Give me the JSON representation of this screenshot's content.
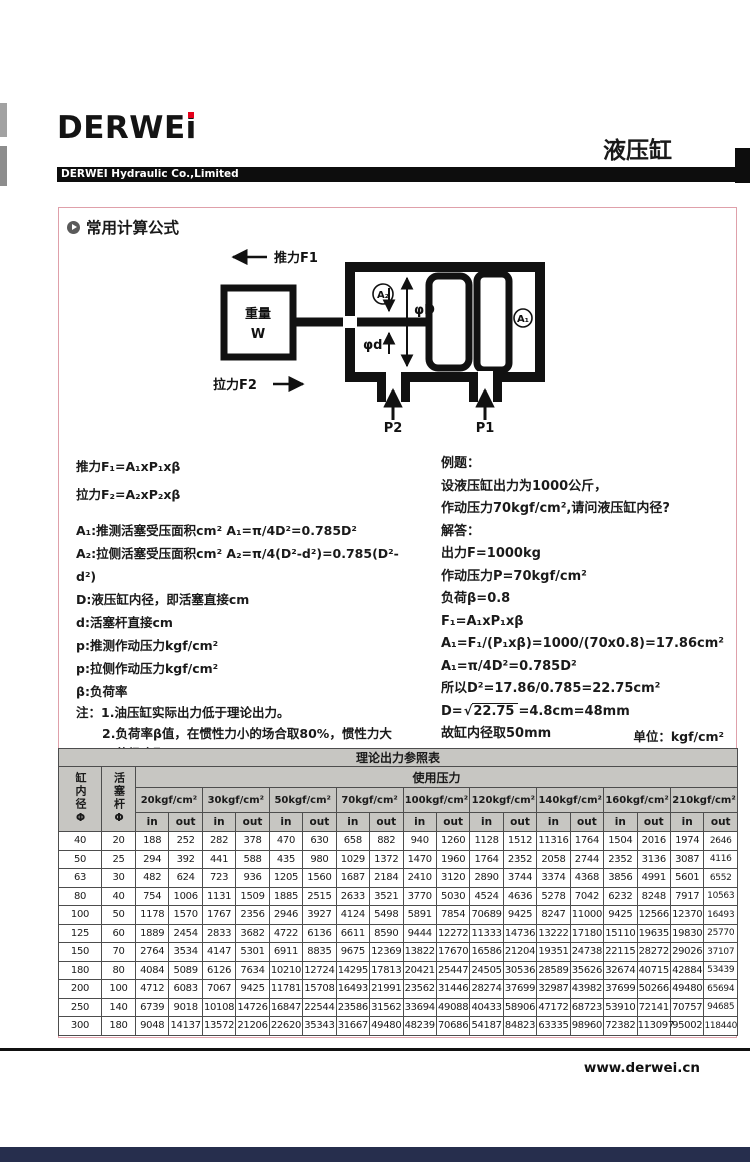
{
  "header": {
    "logo_text": "DERWE",
    "logo_i": "i",
    "page_title": "液压缸",
    "company": "DERWEI Hydraulic Co.,Limited"
  },
  "section": {
    "title": "常用计算公式"
  },
  "diagram": {
    "push_label": "推力F1",
    "pull_label": "拉力F2",
    "weight_line1": "重量",
    "weight_line2": "W",
    "a1_label": "A₁",
    "a2_label": "A₂",
    "dia_D": "φD",
    "dia_d": "φd",
    "p1_label": "P1",
    "p2_label": "P2"
  },
  "formulas": {
    "force_lines": [
      "推力F₁=A₁xP₁xβ",
      "拉力F₂=A₂xP₂xβ"
    ],
    "def_lines": [
      "A₁:推测活塞受压面积cm²  A₁=π/4D²=0.785D²",
      "A₂:拉侧活塞受压面积cm²  A₂=π/4(D²-d²)=0.785(D²-d²)",
      "D:液压缸内径，即活塞直接cm",
      "d:活塞杆直接cm",
      "p:推测作动压力kgf/cm²",
      "p:拉侧作动压力kgf/cm²",
      "β:负荷率"
    ],
    "note_lines": [
      "注：1.油压缸实际出力低于理论出力。",
      "2.负荷率β值，在惯性力小的场合取80%，惯性力大",
      "的场合取60%。"
    ]
  },
  "example": {
    "title": "例题：",
    "question_lines": [
      "设液压缸出力为1000公斤，",
      "作动压力70kgf/cm²,请问液压缸内径?"
    ],
    "answer_label": "解答：",
    "work_lines": [
      "出力F=1000kg",
      "作动压力P=70kgf/cm²",
      "负荷β=0.8",
      "F₁=A₁xP₁xβ",
      "A₁=F₁/(P₁xβ)=1000/(70x0.8)=17.86cm²",
      "A₁=π/4D²=0.785D²",
      "所以D²=17.86/0.785=22.75cm²"
    ],
    "sqrt": {
      "prefix": "D=",
      "sign": "√",
      "value": "22.75",
      "suffix": "=4.8cm=48mm"
    },
    "final_line": "故缸内径取50mm"
  },
  "unit_note": "单位：kgf/cm²",
  "table": {
    "title": "理论出力参照表",
    "col1_header": "缸内径Φ",
    "col2_header": "活塞杆Φ",
    "pressure_header": "使用压力",
    "pressures": [
      "20kgf/cm²",
      "30kgf/cm²",
      "50kgf/cm²",
      "70kgf/cm²",
      "100kgf/cm²",
      "120kgf/cm²",
      "140kgf/cm²",
      "160kgf/cm²",
      "210kgf/cm²"
    ],
    "in_label": "in",
    "out_label": "out",
    "rows": [
      [
        40,
        20,
        188,
        252,
        282,
        378,
        470,
        630,
        658,
        882,
        940,
        1260,
        1128,
        1512,
        11316,
        1764,
        1504,
        2016,
        1974,
        2646
      ],
      [
        50,
        25,
        294,
        392,
        441,
        588,
        435,
        980,
        1029,
        1372,
        1470,
        1960,
        1764,
        2352,
        2058,
        2744,
        2352,
        3136,
        3087,
        4116
      ],
      [
        63,
        30,
        482,
        624,
        723,
        936,
        1205,
        1560,
        1687,
        2184,
        2410,
        3120,
        2890,
        3744,
        3374,
        4368,
        3856,
        4991,
        5601,
        6552
      ],
      [
        80,
        40,
        754,
        1006,
        1131,
        1509,
        1885,
        2515,
        2633,
        3521,
        3770,
        5030,
        4524,
        4636,
        5278,
        7042,
        6232,
        8248,
        7917,
        10563
      ],
      [
        100,
        50,
        1178,
        1570,
        1767,
        2356,
        2946,
        3927,
        4124,
        5498,
        5891,
        7854,
        70689,
        9425,
        8247,
        11000,
        9425,
        12566,
        12370,
        16493
      ],
      [
        125,
        60,
        1889,
        2454,
        2833,
        3682,
        4722,
        6136,
        6611,
        8590,
        9444,
        12272,
        11333,
        14736,
        13222,
        17180,
        15110,
        19635,
        19830,
        25770
      ],
      [
        150,
        70,
        2764,
        3534,
        4147,
        5301,
        6911,
        8835,
        9675,
        12369,
        13822,
        17670,
        16586,
        21204,
        19351,
        24738,
        22115,
        28272,
        29026,
        37107
      ],
      [
        180,
        80,
        4084,
        5089,
        6126,
        7634,
        10210,
        12724,
        14295,
        17813,
        20421,
        25447,
        24505,
        30536,
        28589,
        35626,
        32674,
        40715,
        42884,
        53439
      ],
      [
        200,
        100,
        4712,
        6083,
        7067,
        9425,
        11781,
        15708,
        16493,
        21991,
        23562,
        31446,
        28274,
        37699,
        32987,
        43982,
        37699,
        50266,
        49480,
        65694
      ],
      [
        250,
        140,
        6739,
        9018,
        10108,
        14726,
        16847,
        22544,
        23586,
        31562,
        33694,
        49088,
        40433,
        58906,
        47172,
        68723,
        53910,
        72141,
        70757,
        94685
      ],
      [
        300,
        180,
        9048,
        14137,
        13572,
        21206,
        22620,
        35343,
        31667,
        49480,
        48239,
        70686,
        54187,
        84823,
        63335,
        98960,
        72382,
        113097,
        95002,
        118440
      ]
    ]
  },
  "footer": {
    "website": "www.derwei.cn"
  }
}
